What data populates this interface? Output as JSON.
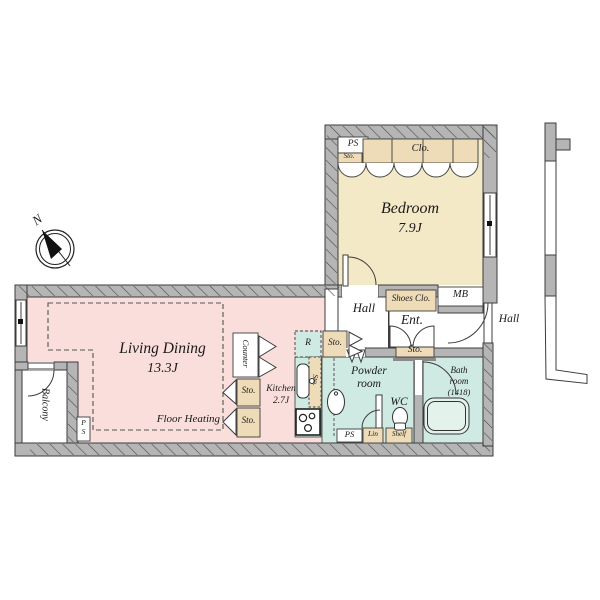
{
  "compass": {
    "north": "N"
  },
  "rooms": {
    "living_dining": {
      "name": "Living Dining",
      "size": "13.3J"
    },
    "bedroom": {
      "name": "Bedroom",
      "size": "7.9J"
    },
    "kitchen": {
      "name": "Kitchen",
      "size": "2.7J"
    },
    "powder_room": {
      "line1": "Powder",
      "line2": "room"
    },
    "bath_room": {
      "line1": "Bath",
      "line2": "room",
      "size": "(1418)"
    },
    "wc": {
      "name": "WC"
    },
    "hall": {
      "name": "Hall"
    },
    "entrance": {
      "name": "Ent."
    },
    "balcony": {
      "name": "Balcony"
    },
    "common_hall": {
      "name": "Hall"
    }
  },
  "features": {
    "floor_heating": "Floor Heating",
    "counter": "Counter",
    "closet": "Clo.",
    "shoes_closet": "Shoes Clo.",
    "mail_box": "MB",
    "pipe_space": "PS",
    "pipe_space_p": "P",
    "pipe_space_s": "S",
    "storage": "Sto.",
    "refrigerator": "R",
    "linen": "Lin",
    "shelf": "Shelf"
  },
  "colors": {
    "living": "#f9dedb",
    "bedroom": "#f3e9c6",
    "wet_area": "#cfe9e3",
    "storage": "#eedcb8",
    "wall": "#b5b5b5",
    "line": "#3c3c3c",
    "background": "#ffffff"
  }
}
